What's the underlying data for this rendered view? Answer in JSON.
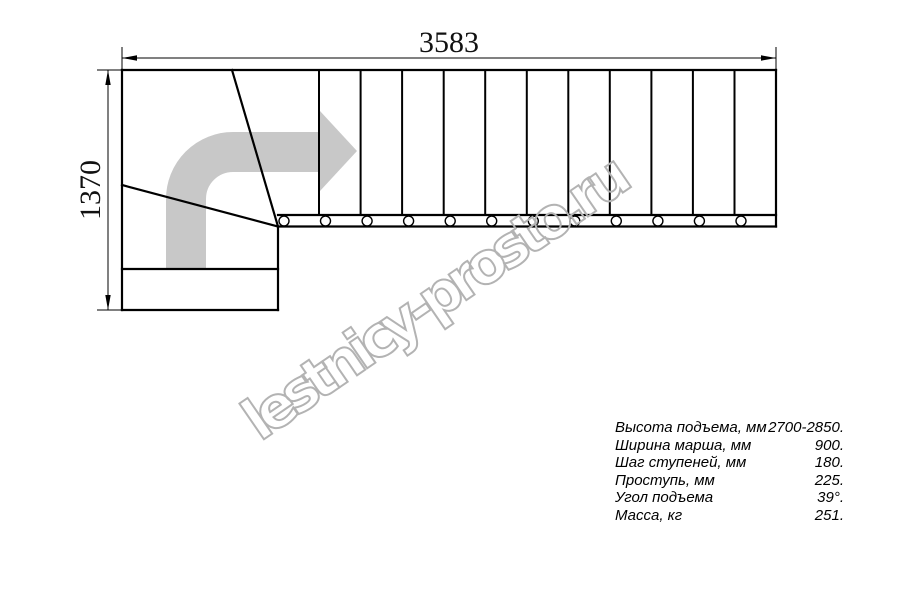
{
  "watermark": {
    "text": "lestnicy-prosto.ru"
  },
  "drawing": {
    "width_label": "3583",
    "height_label": "1370",
    "flight_steps": 12,
    "colors": {
      "line": "#000000",
      "arrow": "#c8c8c8",
      "watermark": "#b3b3b3"
    }
  },
  "specs": {
    "rows": [
      {
        "label": "Высота подъема, мм",
        "value": "2700-2850."
      },
      {
        "label": "Ширина марша, мм",
        "value": "900."
      },
      {
        "label": "Шаг ступеней, мм",
        "value": "180."
      },
      {
        "label": "Проступь, мм",
        "value": "225."
      },
      {
        "label": "Угол подъема",
        "value": "39°."
      },
      {
        "label": "Масса, кг",
        "value": "251."
      }
    ]
  }
}
